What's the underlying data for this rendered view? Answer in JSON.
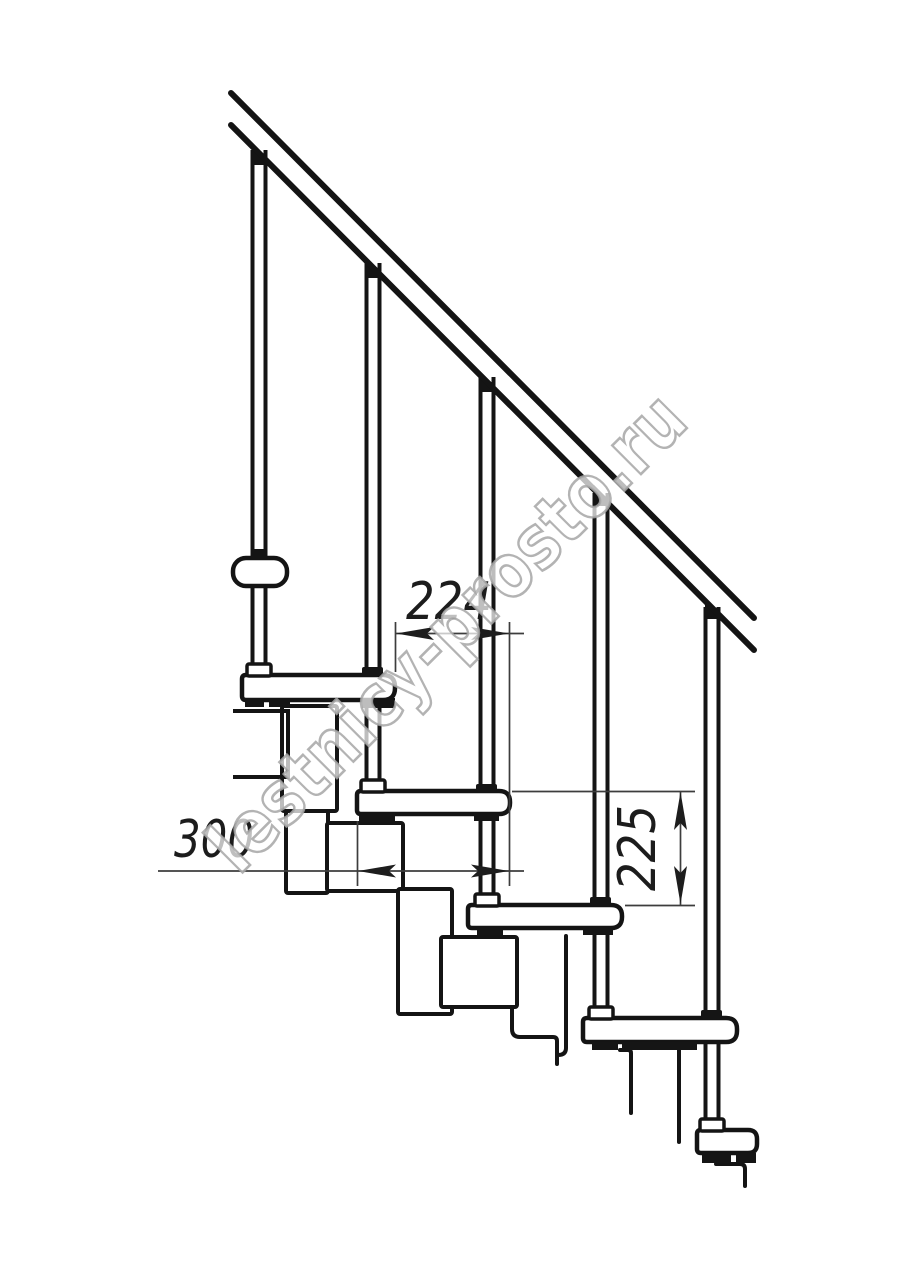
{
  "drawing": {
    "type": "technical-drawing",
    "subject": "modular-staircase-side-view",
    "watermark": "lestnicy-prosto.ru",
    "dimensions": {
      "step_depth": "224",
      "tread_width": "300",
      "step_rise": "225"
    },
    "counts": {
      "treads_visible": 5,
      "balusters_visible": 5
    },
    "colors": {
      "background": "#ffffff",
      "line": "#141414",
      "dim_line": "#3d3d3d",
      "arrow": "#1d1d1d",
      "watermark_stroke": "#a6a6a6",
      "watermark_fill": "#ffffff"
    }
  }
}
